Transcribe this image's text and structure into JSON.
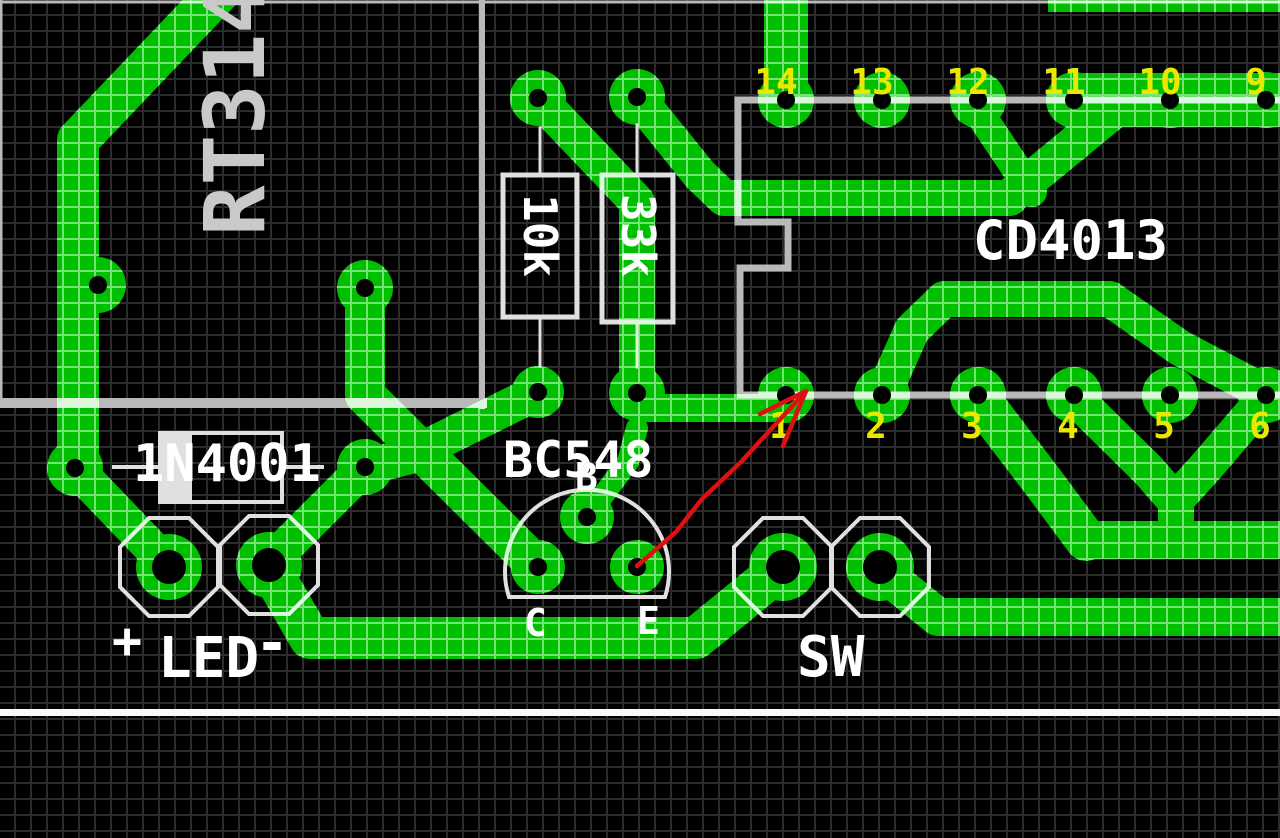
{
  "canvas": {
    "width": 1280,
    "height": 838
  },
  "colors": {
    "board_background": "#000000",
    "copper": "#00BE00",
    "grid_dark": "#2C2C2C",
    "grid_on_copper": "#74E574",
    "silkscreen_gray": "#B9B9B9",
    "silkscreen_bright": "#E0E0E0",
    "silk_over_copper": "#DCF8DC",
    "pin_number_yellow": "#E8E800",
    "label_white": "#FFFFFF",
    "trimmer_label_gray": "#C9C9C9",
    "annotation_arrow_red": "#DD1111",
    "board_edge_line": "#FAFAFA"
  },
  "components": {
    "trimmer_label": "RT314",
    "resistor1_value": "10k",
    "resistor2_value": "33k",
    "ic_name": "CD4013",
    "diode_name": "1N4001",
    "transistor_name": "BC548",
    "transistor_pin_b": "B",
    "transistor_pin_c": "C",
    "transistor_pin_e": "E",
    "led_plus": "+",
    "led_label": "LED",
    "led_minus": "-",
    "switch_label": "SW"
  },
  "ic_pins": {
    "top": [
      "14",
      "13",
      "12",
      "11",
      "10",
      "9"
    ],
    "bottom": [
      "1",
      "2",
      "3",
      "4",
      "5",
      "6"
    ]
  }
}
